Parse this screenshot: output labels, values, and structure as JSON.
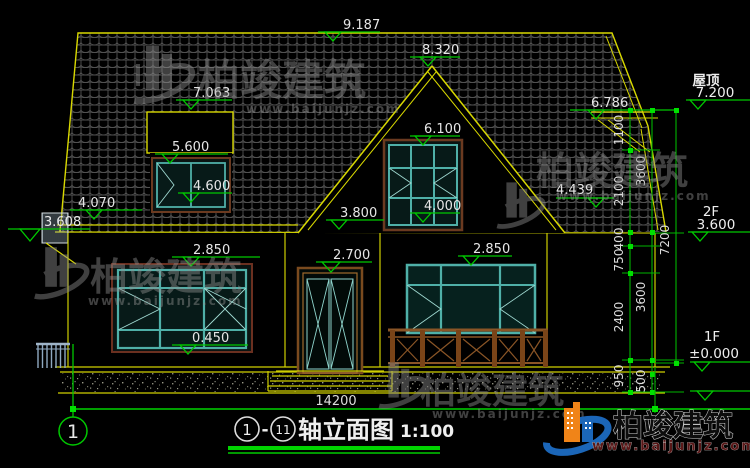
{
  "drawing": {
    "elevation_markers": {
      "ridge": "9.187",
      "gable_peak": "8.320",
      "dormer_top": "7.063",
      "dormer_window_top": "5.600",
      "dormer_window_sill": "4.600",
      "left_eave": "4.070",
      "left_flue": "3.608",
      "attic_window_top": "6.100",
      "attic_window_sill": "4.000",
      "left_wall_top": "3.800",
      "left_window_top": "2.850",
      "left_window_sill": "0.450",
      "door_top": "2.700",
      "right_window_top": "2.850",
      "right_roof_slope": "4.439",
      "right_eave": "6.786"
    },
    "levels": {
      "roof": {
        "label": "屋顶",
        "value": "7.200"
      },
      "floor2": {
        "label": "2F",
        "value": "3.600"
      },
      "floor1": {
        "label": "1F",
        "value": "±0.000"
      }
    },
    "dimensions": {
      "right_chain_inner": [
        "1100",
        "2100",
        "400",
        "750",
        "2400",
        "950"
      ],
      "right_chain_middle": [
        "3600",
        "3600",
        "500"
      ],
      "right_chain_outer": [
        "7200"
      ],
      "overall_width": "14200"
    },
    "axis_bubble": "1",
    "title": {
      "axis_start": "1",
      "separator": "-",
      "axis_end": "11",
      "text": "轴立面图",
      "scale": "1:100"
    }
  },
  "watermark": {
    "brand": "柏竣建筑",
    "url": "www.baijunjz.com"
  },
  "logo": {
    "brand": "柏竣建筑",
    "url": "www.baijunjz.com"
  },
  "colors": {
    "background": "#000000",
    "cad_yellow": "#d8d800",
    "dim_green": "#00c800",
    "frame_teal": "#4fb0a8",
    "wood_brown": "#8a5526",
    "text_white": "#e6e6e6",
    "watermark_gray": "#8f8f8f",
    "logo_blue": "#1b66b8",
    "logo_orange": "#f08418"
  }
}
